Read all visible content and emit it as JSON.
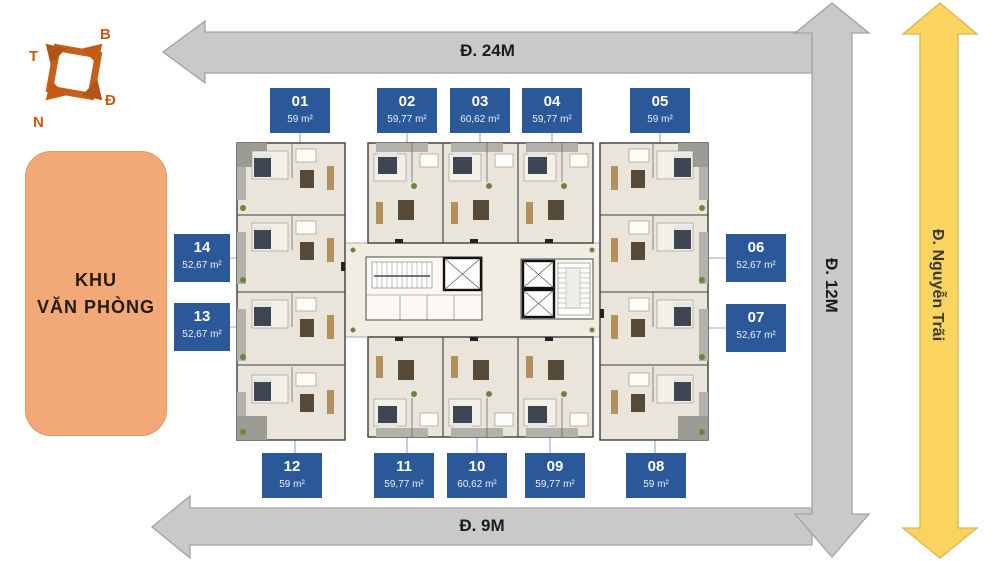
{
  "roads": {
    "top": "Đ. 24M",
    "bottom": "Đ. 9M",
    "side": "Đ. 12M",
    "main": "Đ. Nguyễn Trãi"
  },
  "office": {
    "line1": "KHU",
    "line2": "VĂN PHÒNG"
  },
  "compass": {
    "north": "B",
    "east": "Đ",
    "south": "N",
    "west": "T"
  },
  "units": {
    "u01": {
      "number": "01",
      "area": "59 m²"
    },
    "u02": {
      "number": "02",
      "area": "59,77 m²"
    },
    "u03": {
      "number": "03",
      "area": "60,62 m²"
    },
    "u04": {
      "number": "04",
      "area": "59,77 m²"
    },
    "u05": {
      "number": "05",
      "area": "59 m²"
    },
    "u06": {
      "number": "06",
      "area": "52,67 m²"
    },
    "u07": {
      "number": "07",
      "area": "52,67 m²"
    },
    "u08": {
      "number": "08",
      "area": "59 m²"
    },
    "u09": {
      "number": "09",
      "area": "59,77 m²"
    },
    "u10": {
      "number": "10",
      "area": "60,62 m²"
    },
    "u11": {
      "number": "11",
      "area": "59,77 m²"
    },
    "u12": {
      "number": "12",
      "area": "59 m²"
    },
    "u13": {
      "number": "13",
      "area": "52,67 m²"
    },
    "u14": {
      "number": "14",
      "area": "52,67 m²"
    }
  },
  "colors": {
    "label_blue": "#2B5899",
    "road_gray": "#C9C9C9",
    "road_gray_border": "#A3A3A3",
    "road_yellow": "#FBD45F",
    "office_orange": "#F2A877",
    "compass_orange": "#C55A11",
    "leader_blue": "#93A9C4",
    "plan_floor": "#E9E5DB",
    "plan_bed": "#3E4553",
    "plan_wood": "#584A39",
    "plan_plant": "#67883C"
  }
}
